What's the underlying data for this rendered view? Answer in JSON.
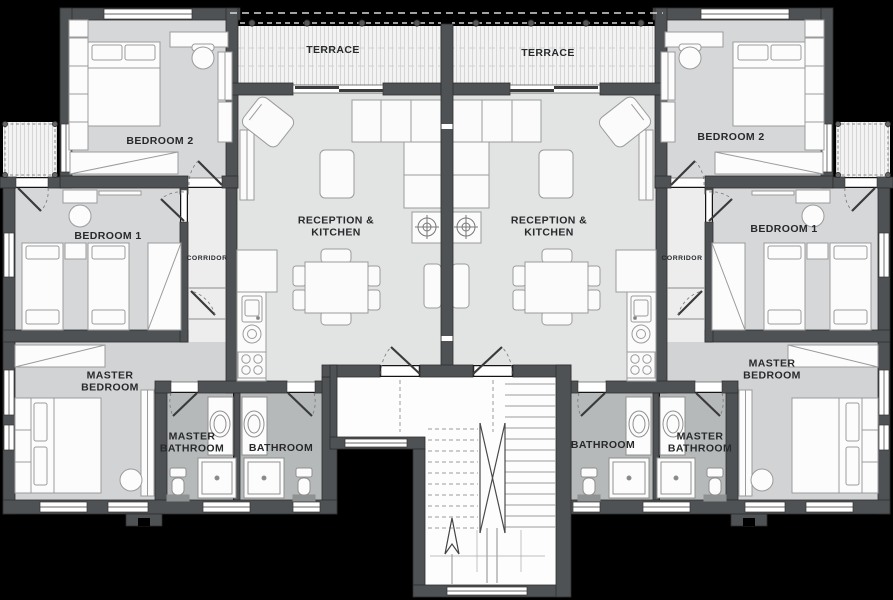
{
  "document": {
    "type": "apartment floor plan",
    "background": "#000000"
  },
  "colors": {
    "wall": "#4f5254",
    "floor_bedroom": "#d6d7d8",
    "floor_reception": "#e2e3e3",
    "floor_corridor": "#ededee",
    "floor_bathroom": "#b6b9b9",
    "floor_stairs": "#fdfdfd",
    "terrace_deck": "#f3f3f3",
    "furniture_fill": "#fcfcfc",
    "furniture_stroke": "#9b9b9b",
    "label_text": "#27292b"
  },
  "units": {
    "left": {
      "terrace": "TERRACE",
      "bedroom2": "BEDROOM 2",
      "reception": "RECEPTION & KITCHEN",
      "bedroom1": "BEDROOM 1",
      "corridor": "CORRIDOR",
      "master_bedroom": "MASTER BEDROOM",
      "master_bathroom": "MASTER BATHROOM",
      "bathroom": "BATHROOM"
    },
    "right": {
      "terrace": "TERRACE",
      "bedroom2": "BEDROOM 2",
      "reception": "RECEPTION & KITCHEN",
      "bedroom1": "BEDROOM 1",
      "corridor": "CORRIDOR",
      "master_bedroom": "MASTER BEDROOM",
      "master_bathroom": "MASTER BATHROOM",
      "bathroom": "BATHROOM"
    }
  }
}
